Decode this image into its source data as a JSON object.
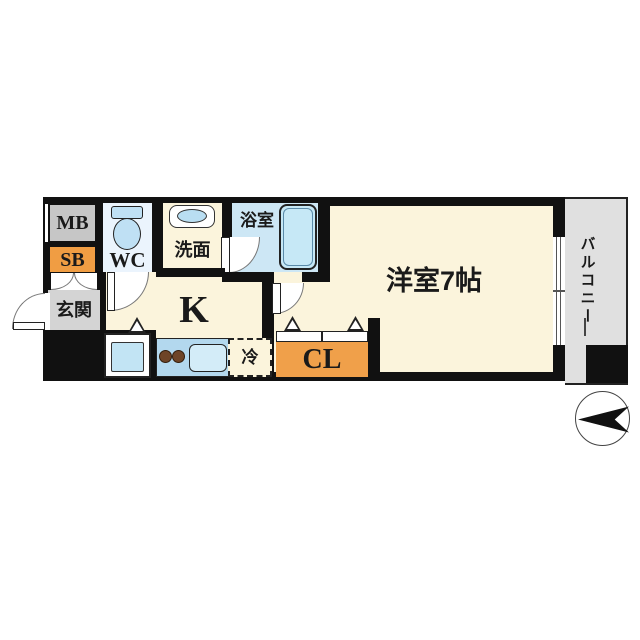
{
  "plan": {
    "type": "japanese-apartment-floor-plan",
    "labels": {
      "mb": "MB",
      "sb": "SB",
      "wc": "WC",
      "entrance": "玄関",
      "washroom": "洗面",
      "bathroom": "浴室",
      "kitchen": "K",
      "fridge": "冷",
      "closet": "CL",
      "main_room": "洋室7帖",
      "balcony": "バルコニー"
    },
    "icons": [
      "toilet-icon",
      "sink-basin-icon",
      "bathtub-icon",
      "stove-burners-icon",
      "kitchen-sink-icon",
      "washer-space-icon",
      "door-swing-arc-icon",
      "folding-door-triangle-icon",
      "compass-arrow-icon"
    ],
    "compass": {
      "arrow_direction": "left"
    },
    "colors": {
      "wall": "#111111",
      "floor_cream": "#fbf4dc",
      "orange_box": "#f09d43",
      "mb_gray": "#c6c6c6",
      "entrance_gray": "#d4d4d4",
      "balcony_gray": "#e0e0e0",
      "bath_blue": "#cde7f5",
      "fixture_blue": "#bfe0f4",
      "counter_blue": "#b3d8ee",
      "wc_floor_blue": "#ebf4fd",
      "burner_brown": "#6e4427"
    }
  }
}
